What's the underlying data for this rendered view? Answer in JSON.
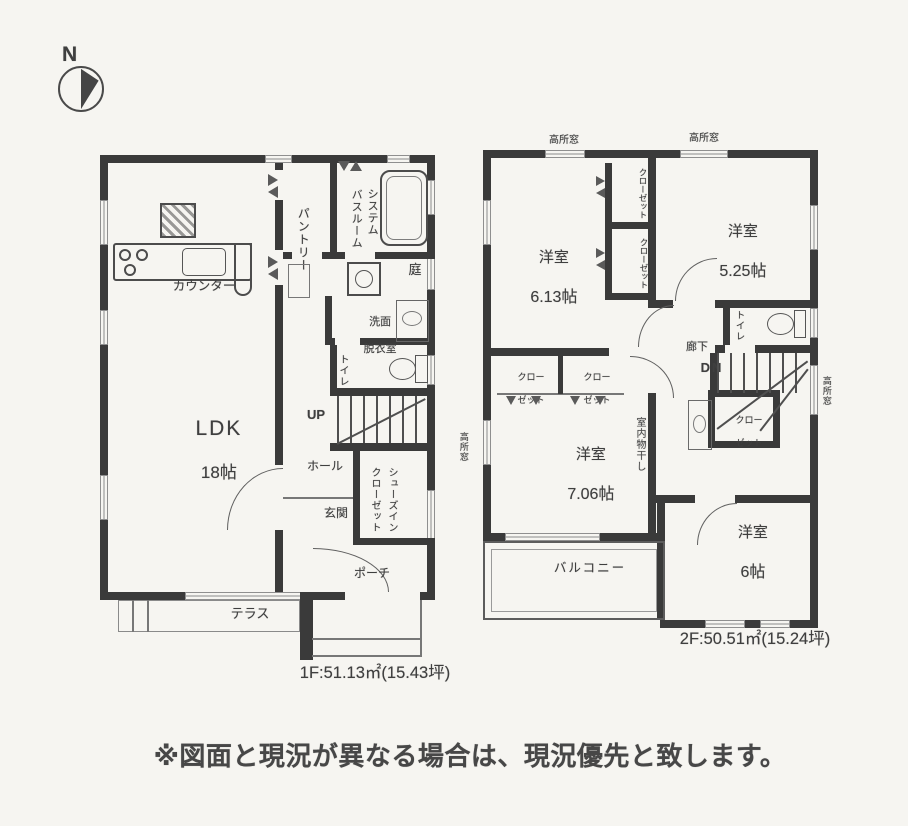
{
  "compass": {
    "n": "N"
  },
  "floor1": {
    "area_label": "1F:51.13㎡(15.43坪)",
    "ldk": {
      "name": "LDK",
      "size": "18帖"
    },
    "counter": "カウンター",
    "pantry": "パントリー",
    "bath": {
      "line1": "システム",
      "line2": "バスルーム"
    },
    "washroom": {
      "line1": "洗面",
      "line2": "脱衣室"
    },
    "garden": "庭",
    "toilet": "トイレ",
    "up": "UP",
    "hall": "ホール",
    "shoes_closet": {
      "line1": "シューズイン",
      "line2": "クローゼット"
    },
    "entrance": "玄関",
    "porch": "ポーチ",
    "terrace": "テラス"
  },
  "floor2": {
    "area_label": "2F:50.51㎡(15.24坪)",
    "bedroom_613": {
      "name": "洋室",
      "size": "6.13帖"
    },
    "bedroom_525": {
      "name": "洋室",
      "size": "5.25帖"
    },
    "bedroom_706": {
      "name": "洋室",
      "size": "7.06帖"
    },
    "bedroom_6": {
      "name": "洋室",
      "size": "6帖"
    },
    "closet": {
      "full": "クローゼット",
      "line1": "クロー",
      "line2": "ゼット"
    },
    "toilet": "トイレ",
    "hallway": "廊下",
    "dn": "DN",
    "balcony": "バルコニー",
    "high_window": "高所窓",
    "indoor_laundry": "室内物干し"
  },
  "caption": "※図面と現況が異なる場合は、現況優先と致します。"
}
